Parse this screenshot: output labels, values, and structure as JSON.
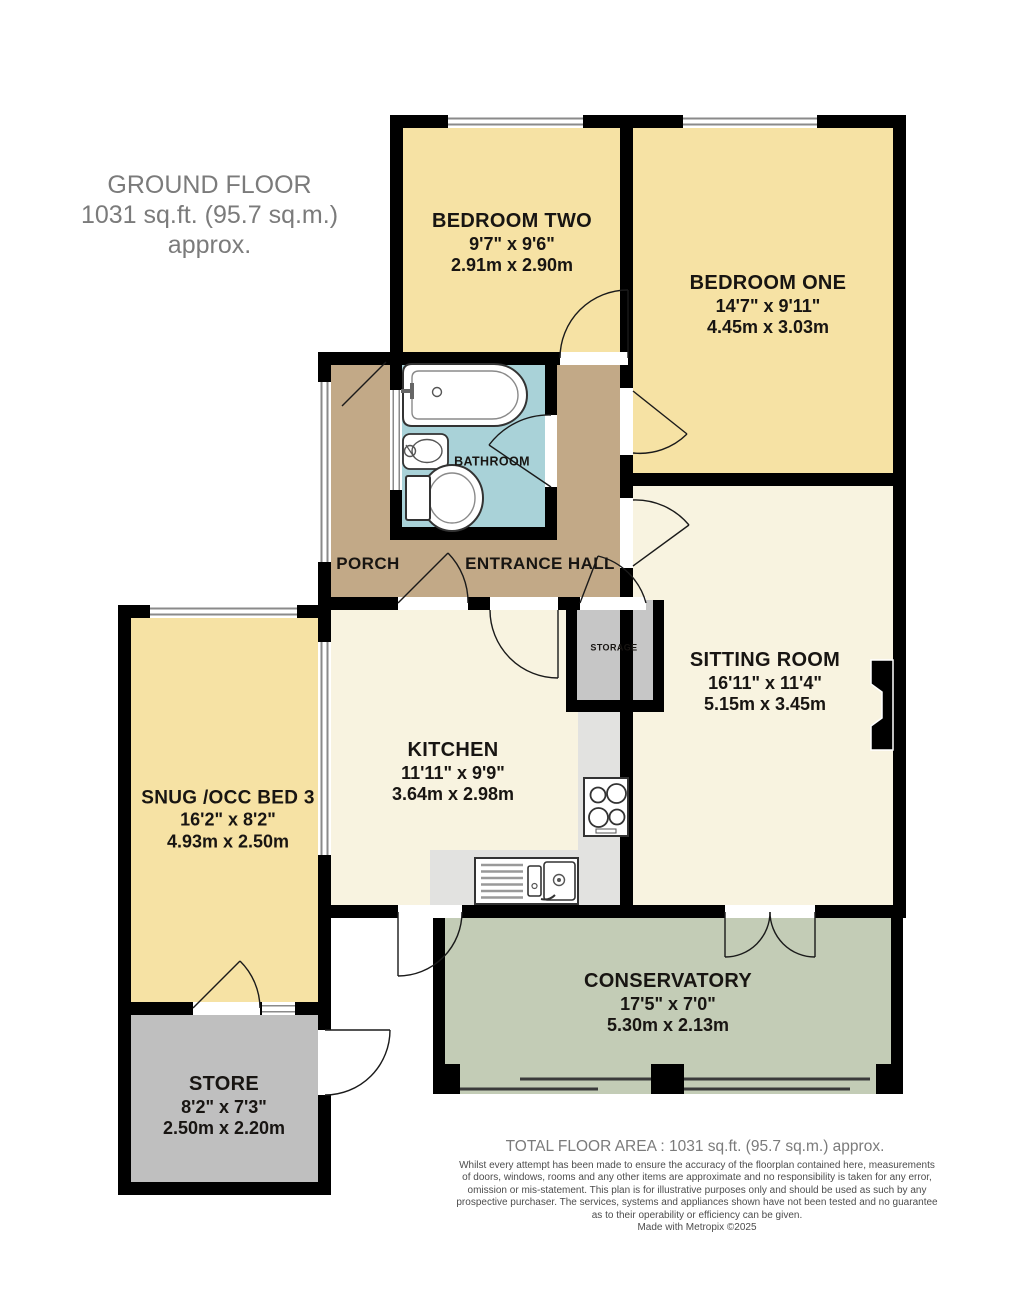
{
  "title": {
    "line1": "GROUND FLOOR",
    "line2": "1031 sq.ft. (95.7 sq.m.) approx."
  },
  "rooms": {
    "bedroom_two": {
      "name": "BEDROOM TWO",
      "imperial": "9'7\" x 9'6\"",
      "metric": "2.91m x 2.90m"
    },
    "bedroom_one": {
      "name": "BEDROOM ONE",
      "imperial": "14'7\" x 9'11\"",
      "metric": "4.45m x 3.03m"
    },
    "sitting_room": {
      "name": "SITTING ROOM",
      "imperial": "16'11\" x 11'4\"",
      "metric": "5.15m x 3.45m"
    },
    "kitchen": {
      "name": "KITCHEN",
      "imperial": "11'11\" x 9'9\"",
      "metric": "3.64m x 2.98m"
    },
    "snug": {
      "name": "SNUG /OCC BED 3",
      "imperial": "16'2\" x 8'2\"",
      "metric": "4.93m x 2.50m"
    },
    "conservatory": {
      "name": "CONSERVATORY",
      "imperial": "17'5\" x 7'0\"",
      "metric": "5.30m x 2.13m"
    },
    "store": {
      "name": "STORE",
      "imperial": "8'2\" x 7'3\"",
      "metric": "2.50m x 2.20m"
    }
  },
  "labels": {
    "bathroom": "BATHROOM",
    "porch": "PORCH",
    "entrance_hall": "ENTRANCE HALL",
    "storage": "STORAGE"
  },
  "footer": {
    "total": "TOTAL FLOOR AREA : 1031 sq.ft. (95.7 sq.m.) approx.",
    "disclaimer": "Whilst every attempt has been made to ensure the accuracy of the floorplan contained here, measurements\nof doors, windows, rooms and any other items are approximate and no responsibility is taken for any error,\nomission or mis-statement. This plan is for illustrative purposes only and should be used as such by any\nprospective purchaser. The services, systems and appliances shown have not been tested and no guarantee\nas to their operability or efficiency can be given.",
    "credit": "Made with Metropix ©2025"
  },
  "colors": {
    "wall": "#000000",
    "bedroom_fill": "#F6E2A4",
    "living_fill": "#F8F3E0",
    "hall_fill": "#C2A987",
    "bathroom_fill": "#A9D2D8",
    "conservatory_fill": "#C3CCB6",
    "store_fill": "#BFBFBF",
    "storage_fill": "#C6C6C6",
    "counter_fill": "#E2E2E0",
    "title_text": "#7B7B7B",
    "room_text": "#181512"
  }
}
